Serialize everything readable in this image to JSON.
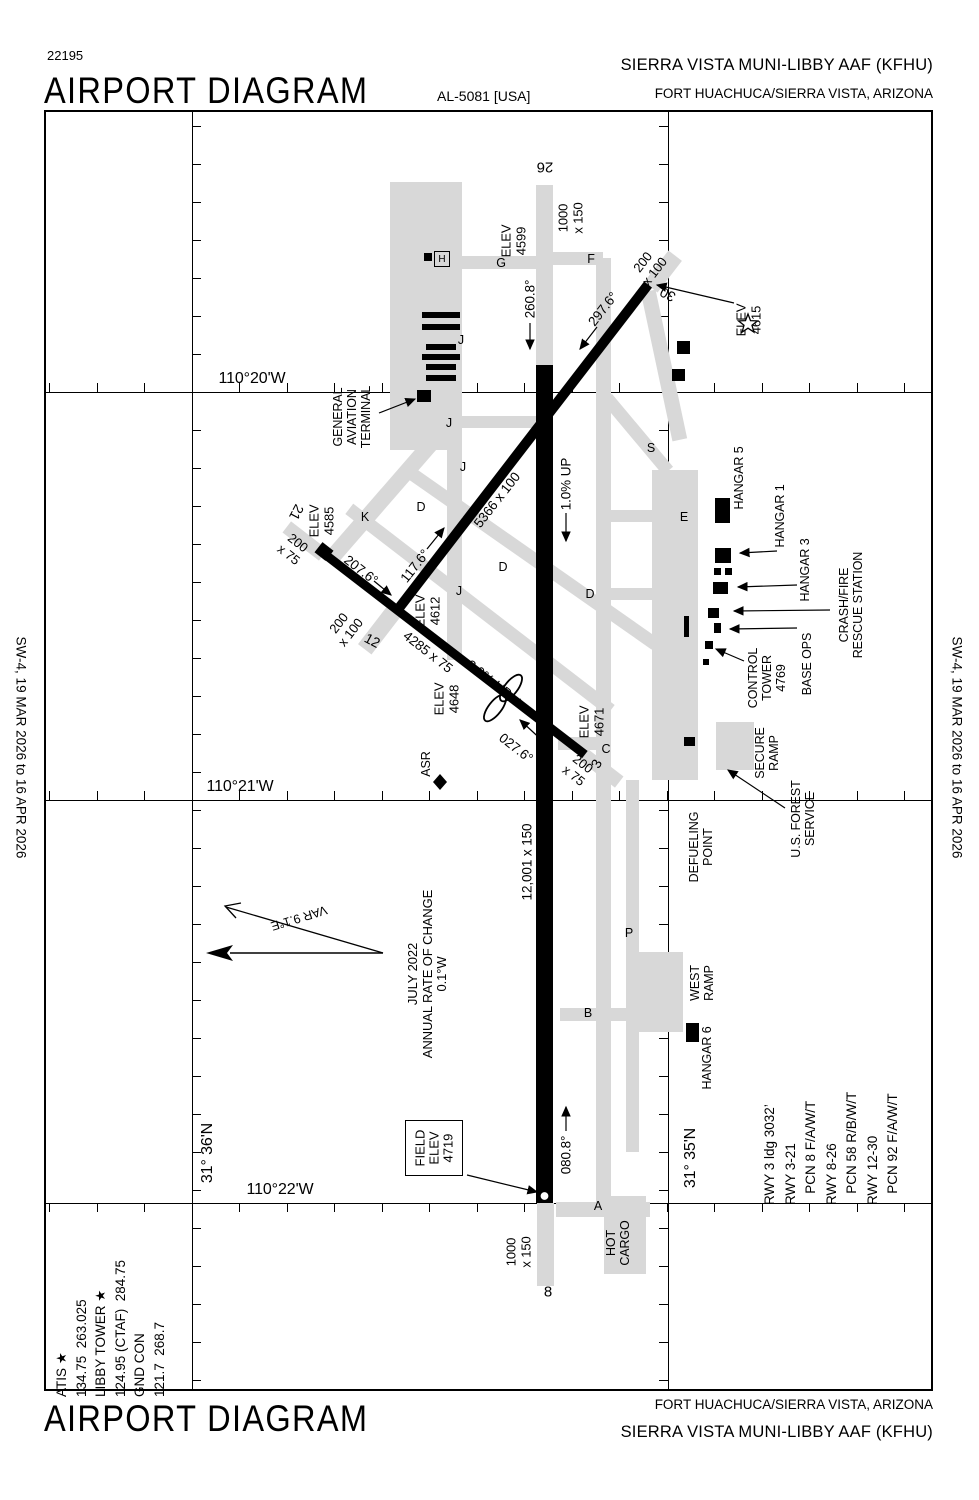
{
  "header": {
    "chart_number": "22195",
    "title": "AIRPORT DIAGRAM",
    "procedure_id": "AL-5081 [USA]",
    "airport_name": "SIERRA VISTA MUNI-LIBBY AAF  (KFHU)",
    "city": "FORT HUACHUCA/SIERRA VISTA, ARIZONA"
  },
  "footer": {
    "title": "AIRPORT DIAGRAM",
    "city": "FORT HUACHUCA/SIERRA VISTA, ARIZONA",
    "airport_name": "SIERRA VISTA MUNI-LIBBY AAF  (KFHU)"
  },
  "margins": {
    "left_edition": "SW-4,  19 MAR 2026  to  16 APR 2026",
    "right_edition": "SW-4,  19 MAR 2026  to  16 APR 2026"
  },
  "info_boxes": {
    "frequencies": "ATIS ★\n134.75  263.025\nLIBBY TOWER ★\n124.95 (CTAF)  284.75\nGND CON\n121.7  268.7",
    "runway_data": "RWY 3 ldg 3032’\nRWY 3-21\n   PCN 8 F/A/W/T\nRWY 8-26\n   PCN 58 R/B/W/T\nRWY 12-30\n   PCN 92 F/A/W/T"
  },
  "map": {
    "colors": {
      "taxiway": "#d8d8d8",
      "runway": "#000000",
      "background": "#ffffff"
    },
    "helipad_letter": "H",
    "field_elev_text": "FIELD\nELEV\n4719",
    "symbols": {
      "airport-beacon-icon": "star-outline",
      "helipad-icon": "boxed-H",
      "asr-icon": "filled-diamond",
      "field-elev-point": "white-dot",
      "north-arrow": "true-north-solid-head",
      "magnetic-north-arrow": "open-head",
      "arresting-gear-icon": "double-loop"
    },
    "gridlines": {
      "vertical_x": [
        192,
        668
      ],
      "horizontal_y": [
        392,
        800,
        1203
      ],
      "chart_box": [
        44,
        110,
        933,
        1391
      ]
    },
    "ticks": [
      {
        "o": "v",
        "x": 192,
        "from": 126,
        "to": 1388,
        "step": 38,
        "len": 9,
        "dir": 1
      },
      {
        "o": "v",
        "x": 668,
        "from": 126,
        "to": 1388,
        "step": 38,
        "len": 9,
        "dir": -1
      },
      {
        "o": "h",
        "y": 392,
        "from": 49,
        "to": 932,
        "step": 47.5,
        "len": 9,
        "dir": -1
      },
      {
        "o": "h",
        "y": 800,
        "from": 49,
        "to": 932,
        "step": 47.5,
        "len": 9,
        "dir": -1
      },
      {
        "o": "h",
        "y": 1203,
        "from": 49,
        "to": 932,
        "step": 47.5,
        "len": 9,
        "dir": 1
      }
    ],
    "taxiways": [
      {
        "x": 390,
        "y": 182,
        "w": 72,
        "h": 268
      },
      {
        "x": 307,
        "y": 492,
        "w": 150,
        "h": 16,
        "r": -49
      },
      {
        "x": 452,
        "y": 256,
        "w": 92,
        "h": 13
      },
      {
        "x": 545,
        "y": 252,
        "w": 58,
        "h": 13
      },
      {
        "x": 596,
        "y": 258,
        "w": 15,
        "h": 950
      },
      {
        "x": 590,
        "y": 428,
        "w": 95,
        "h": 13,
        "r": 50
      },
      {
        "x": 588,
        "y": 358,
        "w": 152,
        "h": 15,
        "r": 78
      },
      {
        "x": 652,
        "y": 470,
        "w": 46,
        "h": 310
      },
      {
        "x": 716,
        "y": 722,
        "w": 38,
        "h": 48
      },
      {
        "x": 626,
        "y": 780,
        "w": 13,
        "h": 372
      },
      {
        "x": 633,
        "y": 952,
        "w": 50,
        "h": 80
      },
      {
        "x": 560,
        "y": 1008,
        "w": 70,
        "h": 13
      },
      {
        "x": 558,
        "y": 737,
        "w": 52,
        "h": 13
      },
      {
        "x": 556,
        "y": 1202,
        "w": 94,
        "h": 15
      },
      {
        "x": 604,
        "y": 1196,
        "w": 42,
        "h": 78
      },
      {
        "x": 447,
        "y": 330,
        "w": 15,
        "h": 330
      },
      {
        "x": 452,
        "y": 416,
        "w": 86,
        "h": 12
      },
      {
        "x": 377,
        "y": 550,
        "w": 306,
        "h": 13,
        "r": 35
      },
      {
        "x": 315,
        "y": 603,
        "w": 330,
        "h": 13,
        "r": 37.6
      },
      {
        "x": 355,
        "y": 621,
        "w": 50,
        "h": 17,
        "r": -52.4
      },
      {
        "x": 643,
        "y": 263,
        "w": 40,
        "h": 17,
        "r": -52.4
      },
      {
        "x": 282,
        "y": 534,
        "w": 46,
        "h": 14,
        "r": 37.6
      },
      {
        "x": 578,
        "y": 761,
        "w": 46,
        "h": 14,
        "r": 37.6
      },
      {
        "x": 536,
        "y": 185,
        "w": 17,
        "h": 182
      },
      {
        "x": 537,
        "y": 1203,
        "w": 17,
        "h": 83
      },
      {
        "x": 611,
        "y": 510,
        "w": 42,
        "h": 12
      },
      {
        "x": 611,
        "y": 588,
        "w": 42,
        "h": 12
      }
    ],
    "runways": [
      {
        "n": "runway-8-26",
        "x": 536,
        "y": 365,
        "w": 17,
        "h": 838
      },
      {
        "n": "runway-12-30",
        "x": 318,
        "y": 442,
        "w": 410,
        "h": 10,
        "r": -52.4
      },
      {
        "n": "runway-3-21",
        "x": 291,
        "y": 650,
        "w": 328,
        "h": 9,
        "r": 37.6
      }
    ],
    "buildings": [
      {
        "x": 422,
        "y": 312,
        "w": 38,
        "h": 6
      },
      {
        "x": 422,
        "y": 324,
        "w": 38,
        "h": 6
      },
      {
        "x": 426,
        "y": 344,
        "w": 30,
        "h": 6
      },
      {
        "x": 422,
        "y": 354,
        "w": 38,
        "h": 6
      },
      {
        "x": 426,
        "y": 364,
        "w": 30,
        "h": 6
      },
      {
        "x": 426,
        "y": 375,
        "w": 30,
        "h": 6
      },
      {
        "x": 417,
        "y": 390,
        "w": 14,
        "h": 12
      },
      {
        "x": 424,
        "y": 253,
        "w": 8,
        "h": 8
      },
      {
        "x": 677,
        "y": 341,
        "w": 13,
        "h": 13
      },
      {
        "x": 672,
        "y": 369,
        "w": 13,
        "h": 12
      },
      {
        "x": 715,
        "y": 498,
        "w": 15,
        "h": 25
      },
      {
        "x": 715,
        "y": 548,
        "w": 16,
        "h": 15
      },
      {
        "x": 714,
        "y": 568,
        "w": 7,
        "h": 7
      },
      {
        "x": 725,
        "y": 568,
        "w": 7,
        "h": 7
      },
      {
        "x": 713,
        "y": 582,
        "w": 15,
        "h": 12
      },
      {
        "x": 708,
        "y": 608,
        "w": 11,
        "h": 10
      },
      {
        "x": 714,
        "y": 623,
        "w": 7,
        "h": 10
      },
      {
        "x": 705,
        "y": 641,
        "w": 8,
        "h": 8
      },
      {
        "x": 703,
        "y": 659,
        "w": 6,
        "h": 6
      },
      {
        "x": 684,
        "y": 616,
        "w": 5,
        "h": 21
      },
      {
        "x": 684,
        "y": 737,
        "w": 11,
        "h": 9
      },
      {
        "x": 686,
        "y": 1023,
        "w": 13,
        "h": 19
      },
      {
        "x": 317,
        "y": 545,
        "w": 14,
        "h": 13,
        "r": 38
      }
    ],
    "labels": [
      {
        "t": "110°20'W",
        "x": 252,
        "y": 379,
        "r": 0,
        "s": 16
      },
      {
        "t": "110°21'W",
        "x": 240,
        "y": 787,
        "r": 0,
        "s": 16
      },
      {
        "t": "110°22'W",
        "x": 280,
        "y": 1190,
        "r": 0,
        "s": 16
      },
      {
        "t": "31° 36'N",
        "x": 208,
        "y": 1153,
        "r": -90,
        "s": 16
      },
      {
        "t": "31° 35'N",
        "x": 691,
        "y": 1158,
        "r": -90,
        "s": 16
      },
      {
        "t": "26",
        "x": 545,
        "y": 166,
        "r": 180,
        "s": 15
      },
      {
        "t": "8",
        "x": 548,
        "y": 1293,
        "r": 0,
        "s": 15
      },
      {
        "t": "30",
        "x": 668,
        "y": 294,
        "r": -152,
        "s": 14
      },
      {
        "t": "12",
        "x": 372,
        "y": 641,
        "r": 28,
        "s": 14
      },
      {
        "t": "21",
        "x": 296,
        "y": 512,
        "r": 118,
        "s": 14
      },
      {
        "t": "3",
        "x": 597,
        "y": 764,
        "r": -62,
        "s": 14
      },
      {
        "t": "G",
        "x": 501,
        "y": 263,
        "r": 0,
        "s": 12.5
      },
      {
        "t": "F",
        "x": 591,
        "y": 259,
        "r": 0,
        "s": 12.5
      },
      {
        "t": "K",
        "x": 365,
        "y": 517,
        "r": 0,
        "s": 12.5
      },
      {
        "t": "E",
        "x": 684,
        "y": 517,
        "r": 0,
        "s": 12.5
      },
      {
        "t": "S",
        "x": 651,
        "y": 448,
        "r": 0,
        "s": 12.5
      },
      {
        "t": "C",
        "x": 606,
        "y": 749,
        "r": 0,
        "s": 12.5
      },
      {
        "t": "B",
        "x": 588,
        "y": 1013,
        "r": 0,
        "s": 12.5
      },
      {
        "t": "P",
        "x": 629,
        "y": 933,
        "r": 0,
        "s": 12.5
      },
      {
        "t": "A",
        "x": 598,
        "y": 1206,
        "r": 0,
        "s": 12.5
      },
      {
        "t": "D",
        "x": 421,
        "y": 507,
        "r": 0,
        "s": 12.5
      },
      {
        "t": "D",
        "x": 503,
        "y": 567,
        "r": 0,
        "s": 12.5
      },
      {
        "t": "D",
        "x": 590,
        "y": 594,
        "r": 0,
        "s": 12.5
      },
      {
        "t": "J",
        "x": 461,
        "y": 340,
        "r": 0,
        "s": 12.5
      },
      {
        "t": "J",
        "x": 449,
        "y": 423,
        "r": 0,
        "s": 12.5
      },
      {
        "t": "J",
        "x": 463,
        "y": 467,
        "r": 0,
        "s": 12.5
      },
      {
        "t": "J",
        "x": 459,
        "y": 591,
        "r": 0,
        "s": 12.5
      },
      {
        "t": "ELEV\n4599",
        "x": 514,
        "y": 241,
        "r": -90,
        "s": 13
      },
      {
        "t": "ELEV\n4615",
        "x": 749,
        "y": 320,
        "r": -90,
        "s": 13
      },
      {
        "t": "ELEV\n4585",
        "x": 322,
        "y": 521,
        "r": -90,
        "s": 13
      },
      {
        "t": "ELEV\n4612",
        "x": 428,
        "y": 611,
        "r": -90,
        "s": 13
      },
      {
        "t": "ELEV\n4648",
        "x": 447,
        "y": 699,
        "r": -90,
        "s": 13
      },
      {
        "t": "ELEV\n4671",
        "x": 592,
        "y": 722,
        "r": -90,
        "s": 13
      },
      {
        "t": "260.8°",
        "x": 530,
        "y": 299,
        "r": -90,
        "s": 13.5
      },
      {
        "t": "080.8°",
        "x": 566,
        "y": 1155,
        "r": -90,
        "s": 13.5
      },
      {
        "t": "297.6°",
        "x": 603,
        "y": 309,
        "r": -52,
        "s": 13.5
      },
      {
        "t": "117.6°",
        "x": 415,
        "y": 566,
        "r": -52,
        "s": 13.5
      },
      {
        "t": "207.6°",
        "x": 361,
        "y": 570,
        "r": 38,
        "s": 13.5
      },
      {
        "t": "027.6°",
        "x": 516,
        "y": 748,
        "r": 38,
        "s": 13.5
      },
      {
        "t": "1000\nx 150",
        "x": 571,
        "y": 218,
        "r": -90,
        "s": 13
      },
      {
        "t": "200\nx 100",
        "x": 649,
        "y": 267,
        "r": -52,
        "s": 13
      },
      {
        "t": "200\nx 75",
        "x": 293,
        "y": 549,
        "r": 38,
        "s": 13
      },
      {
        "t": "200\nx 100",
        "x": 345,
        "y": 628,
        "r": -52,
        "s": 13
      },
      {
        "t": "200\nx 75",
        "x": 578,
        "y": 770,
        "r": 38,
        "s": 13
      },
      {
        "t": "1000\nx 150",
        "x": 519,
        "y": 1252,
        "r": -90,
        "s": 13
      },
      {
        "t": "5366 x 100",
        "x": 497,
        "y": 500,
        "r": -52,
        "s": 13.5
      },
      {
        "t": "4285 x 75",
        "x": 428,
        "y": 652,
        "r": 38,
        "s": 13.5
      },
      {
        "t": "12,001 x 150",
        "x": 527,
        "y": 862,
        "r": -90,
        "s": 13.5
      },
      {
        "t": "1.0% UP",
        "x": 566,
        "y": 484,
        "r": -90,
        "s": 13.5
      },
      {
        "t": "2.0% UP",
        "x": 489,
        "y": 679,
        "r": 38,
        "s": 13.5
      },
      {
        "t": "GENERAL\nAVIATION\nTERMINAL",
        "x": 352,
        "y": 417,
        "r": -90,
        "s": 12.5
      },
      {
        "t": "HANGAR 5",
        "x": 739,
        "y": 478,
        "r": -90,
        "s": 12.5
      },
      {
        "t": "HANGAR 1",
        "x": 780,
        "y": 516,
        "r": -90,
        "s": 12.5
      },
      {
        "t": "HANGAR 3",
        "x": 805,
        "y": 570,
        "r": -90,
        "s": 12.5
      },
      {
        "t": "CRASH/FIRE\nRESCUE STATION",
        "x": 851,
        "y": 605,
        "r": -90,
        "s": 12.5
      },
      {
        "t": "CONTROL\nTOWER\n4769",
        "x": 767,
        "y": 678,
        "r": -90,
        "s": 12.5
      },
      {
        "t": "BASE OPS",
        "x": 807,
        "y": 664,
        "r": -90,
        "s": 12.5
      },
      {
        "t": "SECURE\nRAMP",
        "x": 767,
        "y": 753,
        "r": -90,
        "s": 12.5
      },
      {
        "t": "U.S. FOREST\nSERVICE",
        "x": 803,
        "y": 819,
        "r": -90,
        "s": 12.5
      },
      {
        "t": "DEFUELING\nPOINT",
        "x": 701,
        "y": 847,
        "r": -90,
        "s": 12.5
      },
      {
        "t": "WEST\nRAMP",
        "x": 702,
        "y": 983,
        "r": -90,
        "s": 12.5
      },
      {
        "t": "HANGAR 6",
        "x": 707,
        "y": 1058,
        "r": -90,
        "s": 12.5
      },
      {
        "t": "HOT\nCARGO",
        "x": 618,
        "y": 1243,
        "r": -90,
        "s": 12.5
      },
      {
        "t": "ASR",
        "x": 426,
        "y": 764,
        "r": -90,
        "s": 12.5
      },
      {
        "t": "VAR 9.1°E",
        "x": 299,
        "y": 918,
        "r": 163,
        "s": 12.5
      },
      {
        "t": "JULY 2022\nANNUAL RATE OF CHANGE\n0.1°W",
        "x": 428,
        "y": 974,
        "r": -90,
        "s": 13
      }
    ],
    "arrows": [
      [
        530,
        323,
        530,
        349
      ],
      [
        566,
        1131,
        566,
        1107
      ],
      [
        597,
        327,
        580,
        349
      ],
      [
        427,
        549,
        444,
        528
      ],
      [
        374,
        581,
        391,
        595
      ],
      [
        546,
        744,
        520,
        720
      ],
      [
        566,
        513,
        566,
        541
      ],
      [
        503,
        691,
        525,
        708
      ],
      [
        379,
        413,
        415,
        399
      ],
      [
        777,
        551,
        740,
        553
      ],
      [
        797,
        585,
        738,
        587
      ],
      [
        830,
        610,
        734,
        611
      ],
      [
        797,
        628,
        730,
        629
      ],
      [
        744,
        661,
        716,
        649
      ],
      [
        785,
        808,
        728,
        770
      ],
      [
        734,
        303,
        657,
        285
      ],
      [
        467,
        1175,
        537,
        1192
      ]
    ]
  }
}
